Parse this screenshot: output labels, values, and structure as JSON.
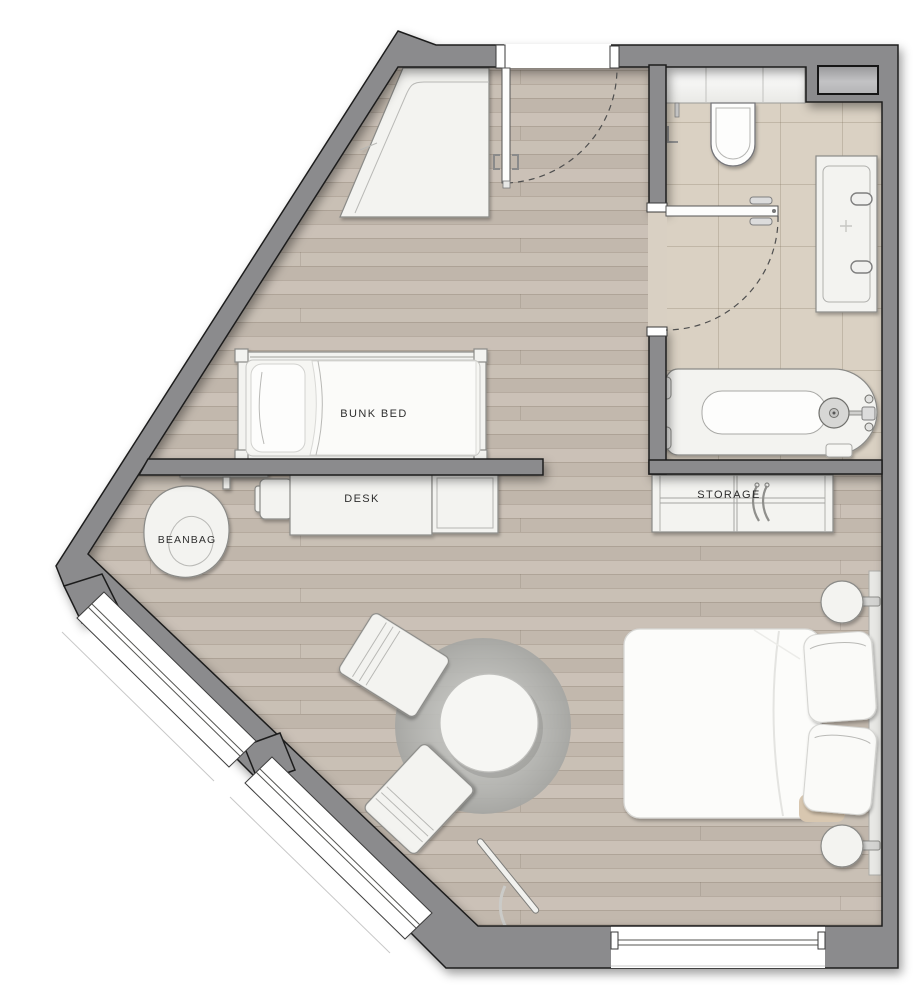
{
  "labels": {
    "bunk_bed": "BUNK BED",
    "desk": "DESK",
    "beanbag": "BEANBAG",
    "storage": "STORAGE"
  },
  "colors": {
    "wall": "#8b8b8d",
    "wall_outline": "#1e1e1e",
    "wood_floor": "#c6bcb2",
    "tile_floor": "#dad1c3",
    "furniture": "#f3f3f0",
    "furniture_outline": "#8a8a87",
    "rug": "#b9bab6",
    "chrome": "#dcdcdc",
    "label_text": "#2e2e2e",
    "background": "#ffffff"
  }
}
